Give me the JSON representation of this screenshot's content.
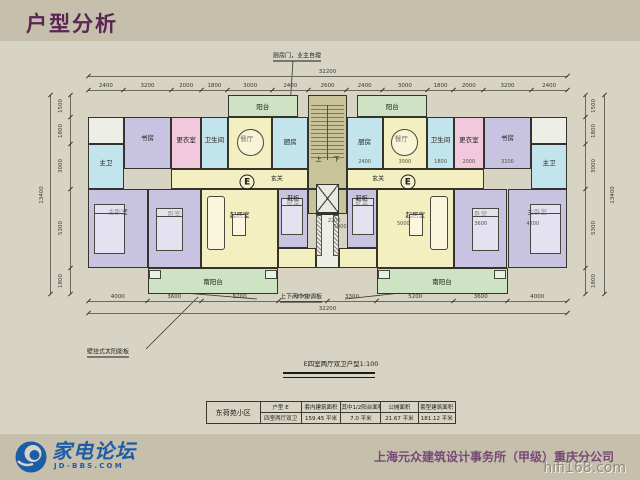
{
  "title": "户型分析",
  "colors": {
    "slide_bg": "#c5bfac",
    "sheet_bg": "#d8d4c4",
    "title": "#5a2455",
    "wall": "#35332c",
    "logo_blue": "#1c5ca8",
    "company_purple": "#774878",
    "watermark_gray": "#8f8c7c",
    "fills": {
      "yellow": "#f4efc1",
      "lavender": "#c8c3e0",
      "cyan": "#c2e4ec",
      "pink": "#f2c8dc",
      "green": "#cde3c4",
      "olive": "#c8c399",
      "light": "#edeee6"
    }
  },
  "plan": {
    "caption": "E四室两厅双卫户型1:100",
    "dims": {
      "top": [
        "2400",
        "3200",
        "2000",
        "1800",
        "3000",
        "2400",
        "2600",
        "2400",
        "3000",
        "1800",
        "2000",
        "3200",
        "2400"
      ],
      "bottom": [
        "4000",
        "3600",
        "5200",
        "3300",
        "3300",
        "5200",
        "3600",
        "4000"
      ],
      "left": [
        "1500",
        "1800",
        "3000",
        "5300",
        "1800"
      ],
      "right": [
        "1500",
        "1800",
        "3000",
        "5300",
        "1800"
      ],
      "top_total": "32200",
      "bottom_total": "32200",
      "left_total": "13400",
      "right_total": "13400"
    },
    "inner_dims": [
      {
        "text": "2400",
        "x": 18600,
        "y": 4500
      },
      {
        "text": "3000",
        "x": 21300,
        "y": 4500
      },
      {
        "text": "1800",
        "x": 23700,
        "y": 4500
      },
      {
        "text": "2000",
        "x": 25600,
        "y": 4500
      },
      {
        "text": "3200",
        "x": 28200,
        "y": 4500
      },
      {
        "text": "2200",
        "x": 16550,
        "y": 8450
      },
      {
        "text": "5000",
        "x": 16950,
        "y": 8850
      },
      {
        "text": "5000",
        "x": 21200,
        "y": 8650
      },
      {
        "text": "3600",
        "x": 26400,
        "y": 8650
      },
      {
        "text": "4200",
        "x": 29900,
        "y": 8650
      }
    ],
    "rooms": [
      {
        "name": "north-balcony",
        "label": "阳台",
        "x": 9400,
        "y": 0,
        "w": 4700,
        "h": 1500,
        "fill": "green",
        "mirror": true
      },
      {
        "name": "stair-core",
        "label": "",
        "x": 14800,
        "y": 0,
        "w": 2600,
        "h": 6300,
        "fill": "olive",
        "mirror": false
      },
      {
        "name": "corner-room",
        "label": "",
        "x": 0,
        "y": 1500,
        "w": 2400,
        "h": 1800,
        "fill": "light",
        "mirror": true
      },
      {
        "name": "study",
        "label": "书房",
        "x": 2400,
        "y": 1500,
        "w": 3200,
        "h": 3500,
        "fill": "lavender",
        "mirror": true,
        "ly": 0.38
      },
      {
        "name": "dressing-room",
        "label": "更衣室",
        "x": 5600,
        "y": 1500,
        "w": 2000,
        "h": 3500,
        "fill": "pink",
        "mirror": true,
        "ly": 0.42
      },
      {
        "name": "bathroom",
        "label": "卫生间",
        "x": 7600,
        "y": 1500,
        "w": 1800,
        "h": 3500,
        "fill": "cyan",
        "mirror": true,
        "ly": 0.42
      },
      {
        "name": "dining-room",
        "label": "餐厅",
        "x": 9400,
        "y": 1500,
        "w": 3000,
        "h": 3500,
        "fill": "yellow",
        "mirror": true,
        "lx": 0.42,
        "ly": 0.4
      },
      {
        "name": "kitchen",
        "label": "厨房",
        "x": 12400,
        "y": 1500,
        "w": 2400,
        "h": 3500,
        "fill": "cyan",
        "mirror": true,
        "ly": 0.45
      },
      {
        "name": "master-bath",
        "label": "主卫",
        "x": 0,
        "y": 3300,
        "w": 2400,
        "h": 3000,
        "fill": "cyan",
        "mirror": true,
        "ly": 0.4
      },
      {
        "name": "foyer",
        "label": "",
        "x": 5600,
        "y": 5000,
        "w": 9200,
        "h": 1300,
        "fill": "yellow",
        "mirror": true
      },
      {
        "name": "living-room",
        "label": "起居室",
        "x": 7600,
        "y": 6300,
        "w": 5200,
        "h": 5300,
        "fill": "yellow",
        "mirror": true,
        "ly": 0.32
      },
      {
        "name": "master-bedroom",
        "label": "主卧室",
        "x": 0,
        "y": 6300,
        "w": 4000,
        "h": 5300,
        "fill": "lavender",
        "mirror": true,
        "ly": 0.28
      },
      {
        "name": "bedroom",
        "label": "卧室",
        "x": 4000,
        "y": 6300,
        "w": 3600,
        "h": 5300,
        "fill": "lavender",
        "mirror": true,
        "ly": 0.3
      },
      {
        "name": "inner-bedroom",
        "label": "卧室",
        "x": 12800,
        "y": 6300,
        "w": 2000,
        "h": 4000,
        "fill": "lavender",
        "mirror": true,
        "ly": 0.2
      },
      {
        "name": "elevator-lobby",
        "label": "",
        "x": 14800,
        "y": 6300,
        "w": 2600,
        "h": 1700,
        "fill": "olive",
        "mirror": false
      },
      {
        "name": "center-shaft",
        "label": "",
        "x": 15300,
        "y": 8000,
        "w": 1600,
        "h": 3600,
        "fill": "light",
        "mirror": false
      },
      {
        "name": "center-passage",
        "label": "",
        "x": 12800,
        "y": 10300,
        "w": 2500,
        "h": 1300,
        "fill": "yellow",
        "mirror": true
      },
      {
        "name": "south-balcony",
        "label": "南阳台",
        "x": 4000,
        "y": 11600,
        "w": 8800,
        "h": 1800,
        "fill": "green",
        "mirror": true
      }
    ],
    "labels": [
      {
        "text": "玄关",
        "x": 12700,
        "y": 5550,
        "mirror": true,
        "cls": "small"
      },
      {
        "text": "E",
        "x": 10700,
        "y": 5850,
        "mirror": true,
        "cls": "circle"
      },
      {
        "text": "鞋柜",
        "x": 13800,
        "y": 6950,
        "mirror": true,
        "cls": "small"
      },
      {
        "text": "上",
        "x": 15500,
        "y": 4300,
        "mirror": false,
        "cls": "small"
      },
      {
        "text": "下",
        "x": 16700,
        "y": 4300,
        "mirror": false,
        "cls": "small"
      }
    ],
    "furniture": [
      {
        "type": "circle",
        "name": "dining-table",
        "x": 10000,
        "y": 2300,
        "w": 1800,
        "h": 1800,
        "mirror": true
      },
      {
        "type": "bed",
        "name": "bed",
        "x": 400,
        "y": 7300,
        "w": 2100,
        "h": 3400,
        "mirror": true
      },
      {
        "type": "bed",
        "name": "bed",
        "x": 4600,
        "y": 7600,
        "w": 1800,
        "h": 2900,
        "mirror": true
      },
      {
        "type": "bed",
        "name": "bed",
        "x": 12950,
        "y": 6900,
        "w": 1500,
        "h": 2500,
        "mirror": true
      },
      {
        "type": "sofa",
        "name": "sofa",
        "x": 8000,
        "y": 6800,
        "w": 1200,
        "h": 3600,
        "mirror": true
      },
      {
        "type": "rect",
        "name": "coffee-table",
        "x": 9700,
        "y": 8000,
        "w": 900,
        "h": 1500,
        "mirror": true
      },
      {
        "type": "stairs",
        "name": "staircase",
        "x": 15000,
        "y": 700,
        "w": 2200,
        "h": 3700,
        "mirror": false
      },
      {
        "type": "elevator",
        "name": "elevator",
        "x": 15300,
        "y": 5950,
        "w": 1600,
        "h": 1950,
        "mirror": false
      },
      {
        "type": "hatch",
        "name": "duct",
        "x": 15350,
        "y": 8100,
        "w": 350,
        "h": 2700,
        "mirror": false
      },
      {
        "type": "hatch",
        "name": "duct",
        "x": 16500,
        "y": 8100,
        "w": 350,
        "h": 2700,
        "mirror": false
      },
      {
        "type": "rect",
        "name": "ac-panel",
        "x": 4100,
        "y": 11750,
        "w": 800,
        "h": 650,
        "mirror": true
      },
      {
        "type": "rect",
        "name": "ac-panel",
        "x": 11900,
        "y": 11750,
        "w": 800,
        "h": 650,
        "mirror": true
      }
    ],
    "annotations": [
      {
        "name": "kitchen-door-note",
        "text": "厨房门，业主自理",
        "x": 297,
        "y": 56,
        "lines": [
          [
            293,
            61,
            288,
            136
          ]
        ]
      },
      {
        "name": "solar-panel-note",
        "text": "壁挂式太阳能板",
        "x": 108,
        "y": 352,
        "lines": [
          [
            146,
            349,
            198,
            297
          ]
        ]
      },
      {
        "name": "ac-panel-note",
        "text": "上下两个空调板",
        "x": 301,
        "y": 297,
        "lines": [
          [
            257,
            299,
            160,
            291
          ],
          [
            345,
            299,
            420,
            291
          ]
        ]
      }
    ]
  },
  "table": {
    "project": "东荷苑小区",
    "headers": [
      "户型 E",
      "套内建筑面积",
      "其中1/2阳台面积",
      "公摊面积",
      "套型建筑面积"
    ],
    "values": [
      "四室两厅双卫",
      "159.45 平米",
      "7.0 平米",
      "21.67 平米",
      "181.12 平米"
    ]
  },
  "footer": {
    "logo_text": "家电论坛",
    "logo_domain": "JD-BBS.COM",
    "company": "上海元众建筑设计事务所（甲级）重庆分公司",
    "watermark": "hifi168.com"
  }
}
